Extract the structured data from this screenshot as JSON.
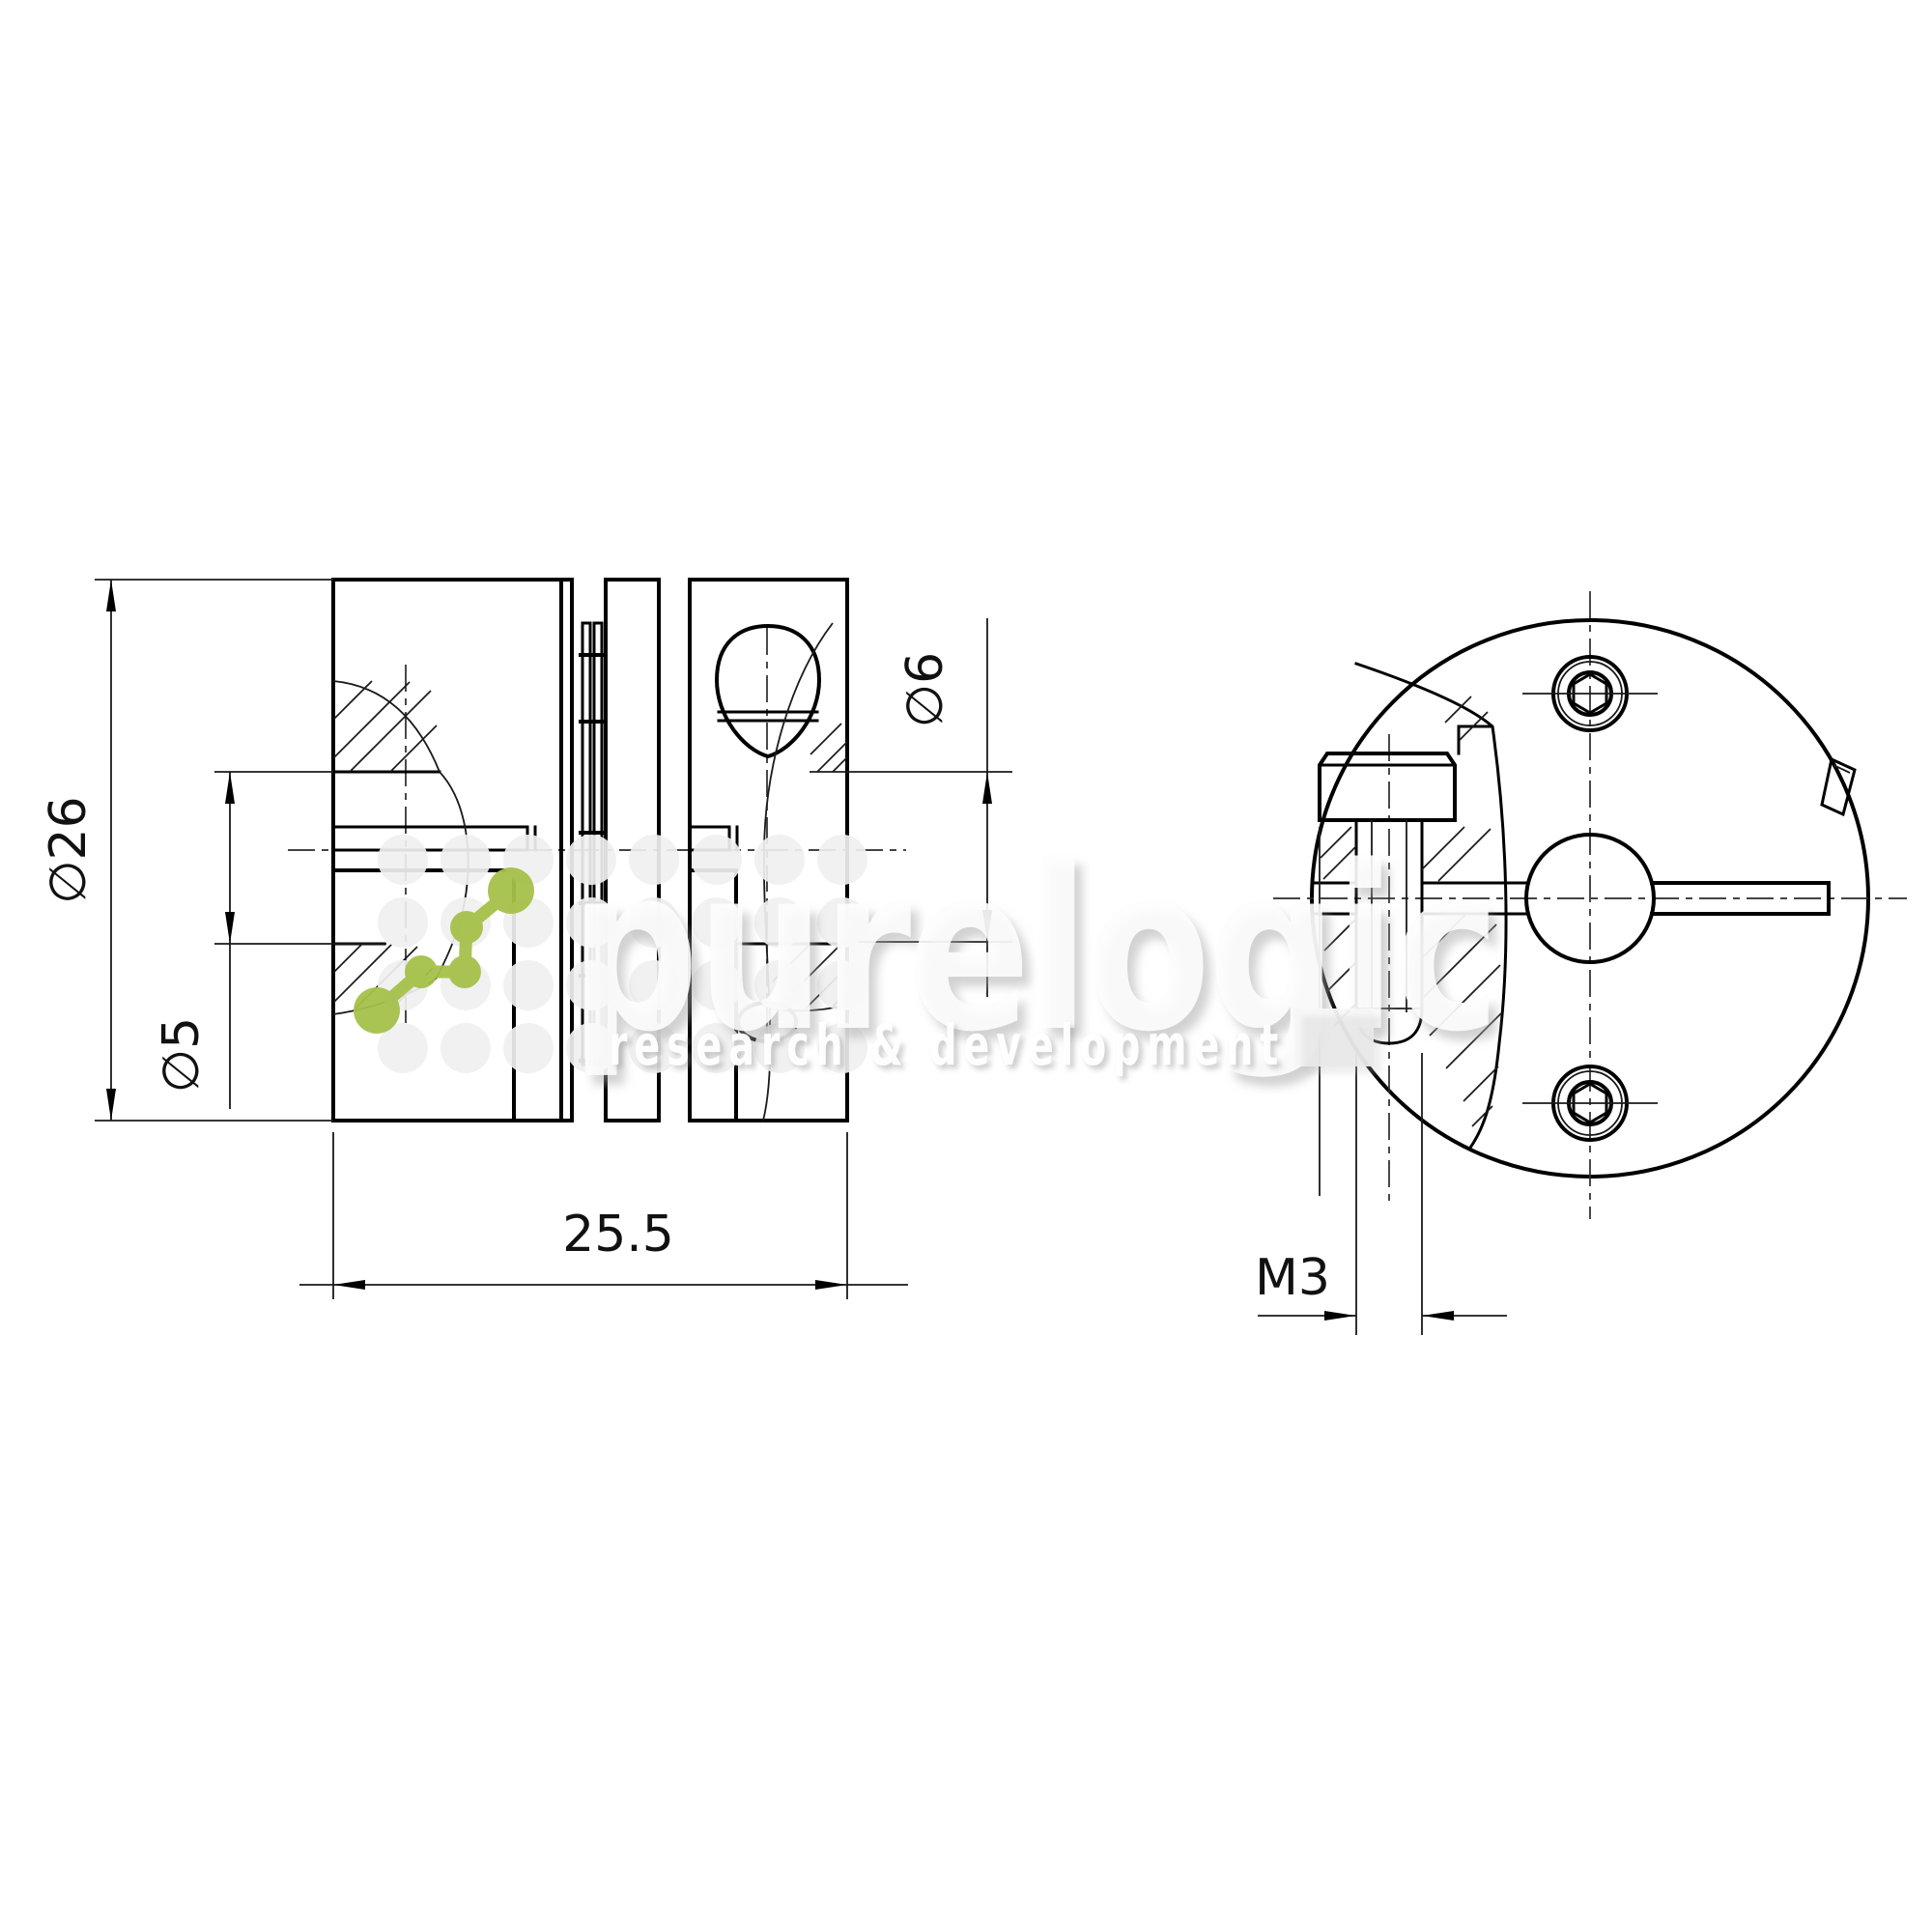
{
  "page": {
    "background": "#ffffff"
  },
  "drawing": {
    "type": "technical-drawing",
    "subject": "disc shaft coupling, section view and face view",
    "dimensions": {
      "outer_diameter": "∅26",
      "left_bore": "∅5",
      "right_bore": "∅6",
      "length": "25.5",
      "clamp_screw_thread": "M3"
    },
    "line_color": "#000000"
  },
  "watermark": {
    "brand": "purelogic",
    "tagline": "research & development",
    "accent_color": "#a6c14b",
    "dot_color": "#f0f0f0"
  }
}
